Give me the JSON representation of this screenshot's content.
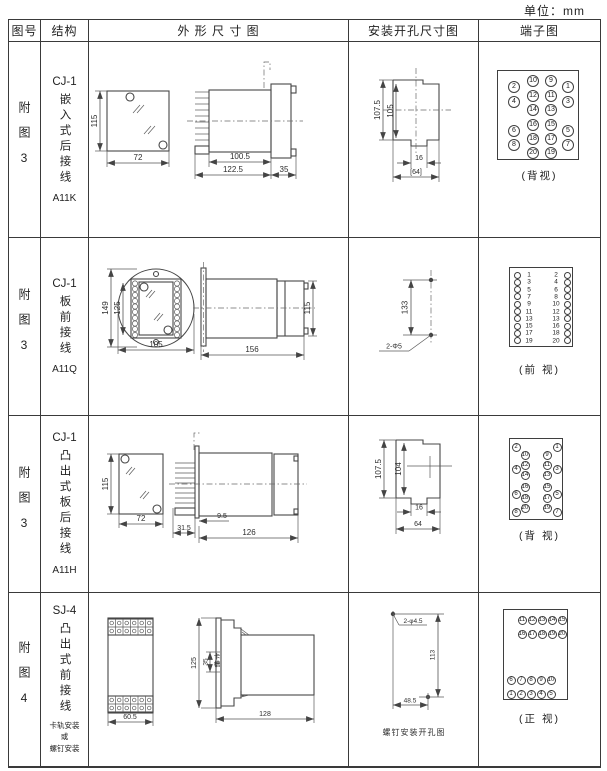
{
  "unit_label": "单位：mm",
  "headers": {
    "fig_no": "图号",
    "structure": "结构",
    "outline": "外 形 尺 寸 图",
    "install": "安装开孔尺寸图",
    "terminal": "端子图"
  },
  "rows": [
    {
      "fig_no": "附图3",
      "model": "CJ-1",
      "desc": "嵌入式后接线",
      "code": "A11K",
      "outline": {
        "d115": "115",
        "d72": "72",
        "d100_5": "100.5",
        "d122_5": "122.5",
        "d35": "35"
      },
      "install": {
        "d_outer": "107.5",
        "d_inner": "105",
        "d_notch": "16",
        "d_width": "[64]"
      },
      "terminal_caption": "(背视)"
    },
    {
      "fig_no": "附图3",
      "model": "CJ-1",
      "desc": "板前接线",
      "code": "A11Q",
      "outline": {
        "d149": "149",
        "d125": "125",
        "d105": "105",
        "d156": "156",
        "d115": "115"
      },
      "install": {
        "d133": "133",
        "hole": "2-Φ5"
      },
      "terminal_caption": "(前 视)"
    },
    {
      "fig_no": "附图3",
      "model": "CJ-1",
      "desc": "凸出式板后接线",
      "code": "A11H",
      "outline": {
        "d115": "115",
        "d72": "72",
        "d31_5": "31.5",
        "d9_5": "9.5",
        "d126": "126"
      },
      "install": {
        "d_outer": "107.5",
        "d_inner": "104",
        "d_notch": "16",
        "d_width": "64"
      },
      "terminal_caption": "(背 视)"
    },
    {
      "fig_no": "附图4",
      "model": "SJ-4",
      "desc": "凸出式前接线",
      "mount": [
        "卡轨安装",
        "或",
        "螺钉安装"
      ],
      "outline": {
        "d60_5": "60.5",
        "d125": "125",
        "d35": "35",
        "slot": "卡槽",
        "d128": "128"
      },
      "install": {
        "hole": "2-φ4.5",
        "d113": "113",
        "d48_5": "48.5",
        "caption": "螺钉安装开孔图"
      },
      "terminal_caption": "(正 视)"
    }
  ],
  "terminals": {
    "t1": {
      "r": 6,
      "font": 7,
      "items": [
        [
          "10",
          35,
          10
        ],
        [
          "9",
          53,
          10
        ],
        [
          "2",
          16,
          16
        ],
        [
          "1",
          70,
          16
        ],
        [
          "12",
          35,
          25
        ],
        [
          "11",
          53,
          25
        ],
        [
          "4",
          16,
          31
        ],
        [
          "3",
          70,
          31
        ],
        [
          "14",
          35,
          39
        ],
        [
          "13",
          53,
          39
        ],
        [
          "16",
          35,
          54
        ],
        [
          "15",
          53,
          54
        ],
        [
          "6",
          16,
          60
        ],
        [
          "5",
          70,
          60
        ],
        [
          "18",
          35,
          68
        ],
        [
          "17",
          53,
          68
        ],
        [
          "8",
          16,
          74
        ],
        [
          "7",
          70,
          74
        ],
        [
          "20",
          35,
          82
        ],
        [
          "19",
          53,
          82
        ]
      ]
    },
    "t2": {
      "r": 3.5,
      "font": 6.5,
      "rows": [
        [
          "1",
          "2"
        ],
        [
          "3",
          "4"
        ],
        [
          "5",
          "6"
        ],
        [
          "7",
          "8"
        ],
        [
          "9",
          "10"
        ],
        [
          "11",
          "12"
        ],
        [
          "13",
          "13"
        ],
        [
          "15",
          "16"
        ],
        [
          "17",
          "18"
        ],
        [
          "19",
          "20"
        ]
      ]
    },
    "t3": {
      "r": 4.5,
      "font": 6,
      "items": [
        [
          "2",
          6,
          8
        ],
        [
          "1",
          47,
          8
        ],
        [
          "10",
          15,
          16
        ],
        [
          "9",
          37,
          16
        ],
        [
          "12",
          15,
          26
        ],
        [
          "11",
          37,
          26
        ],
        [
          "4",
          6,
          30
        ],
        [
          "3",
          47,
          30
        ],
        [
          "14",
          15,
          36
        ],
        [
          "13",
          37,
          36
        ],
        [
          "16",
          15,
          48
        ],
        [
          "15",
          37,
          48
        ],
        [
          "6",
          6,
          55
        ],
        [
          "5",
          47,
          55
        ],
        [
          "18",
          15,
          59
        ],
        [
          "17",
          37,
          59
        ],
        [
          "20",
          15,
          69
        ],
        [
          "19",
          37,
          69
        ],
        [
          "8",
          6,
          73
        ],
        [
          "7",
          47,
          73
        ]
      ]
    },
    "t4": {
      "r": 4.5,
      "font": 6,
      "items": [
        [
          "11",
          18,
          10
        ],
        [
          "12",
          28,
          10
        ],
        [
          "13",
          38,
          10
        ],
        [
          "14",
          48,
          10
        ],
        [
          "15",
          58,
          10
        ],
        [
          "16",
          18,
          24
        ],
        [
          "17",
          28,
          24
        ],
        [
          "18",
          38,
          24
        ],
        [
          "19",
          48,
          24
        ],
        [
          "20",
          58,
          24
        ],
        [
          "6",
          7,
          70
        ],
        [
          "7",
          17,
          70
        ],
        [
          "8",
          27,
          70
        ],
        [
          "9",
          37,
          70
        ],
        [
          "10",
          47,
          70
        ],
        [
          "1",
          7,
          84
        ],
        [
          "2",
          17,
          84
        ],
        [
          "3",
          27,
          84
        ],
        [
          "4",
          37,
          84
        ],
        [
          "5",
          47,
          84
        ]
      ]
    }
  }
}
